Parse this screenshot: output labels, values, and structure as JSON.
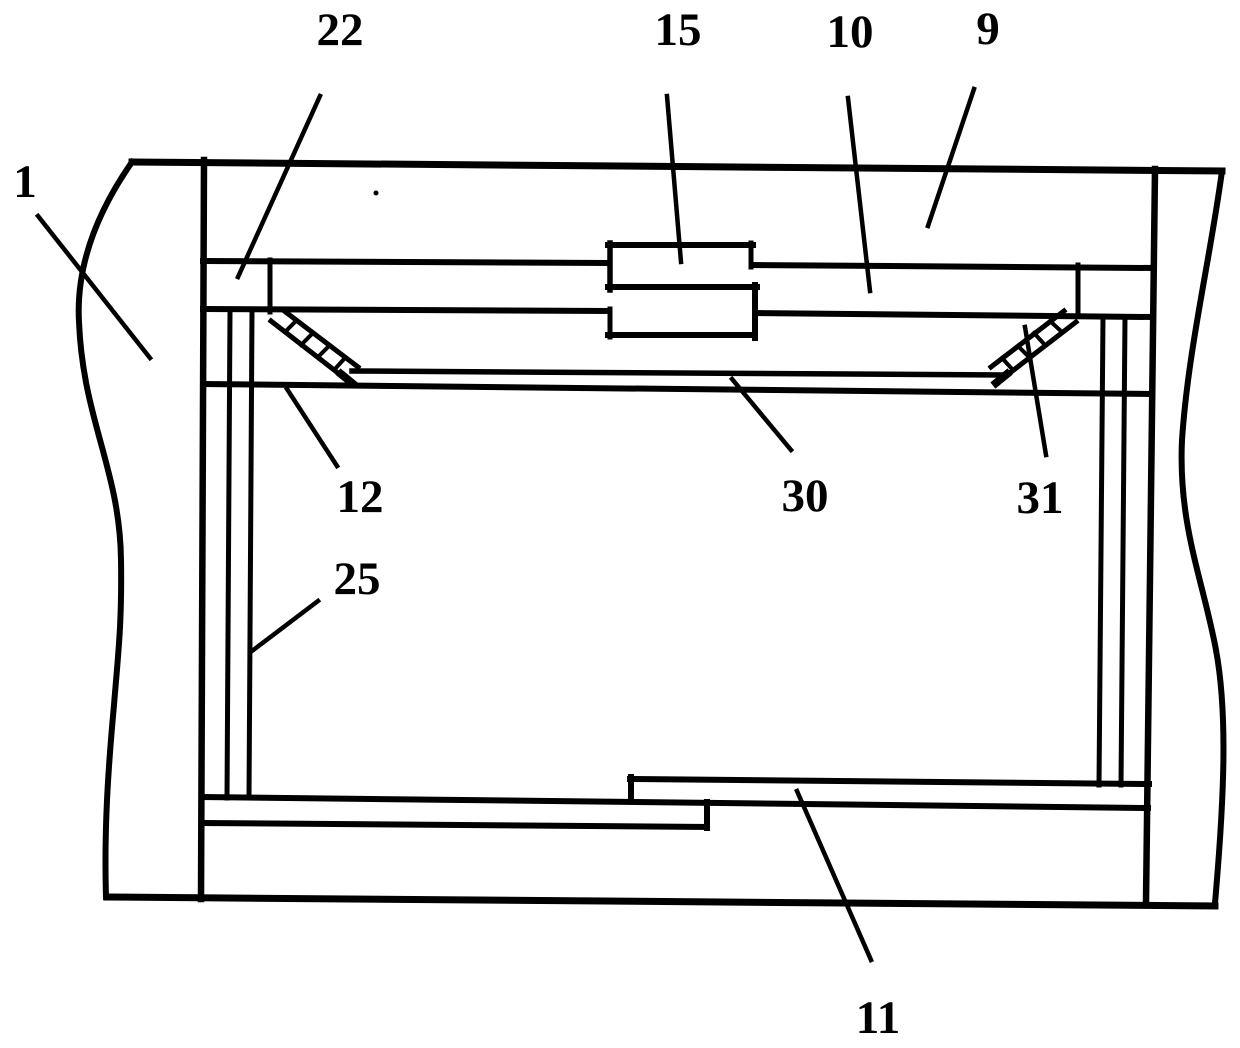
{
  "figure": {
    "background": "#ffffff",
    "ink": "#000000",
    "width": 1240,
    "height": 1048,
    "labels": [
      {
        "id": "1",
        "text": "1",
        "x": 25,
        "y": 180,
        "leader": {
          "x1": 38,
          "y1": 216,
          "x2": 150,
          "y2": 358
        }
      },
      {
        "id": "22",
        "text": "22",
        "x": 340,
        "y": 28,
        "leader": {
          "x1": 320,
          "y1": 96,
          "x2": 238,
          "y2": 277
        }
      },
      {
        "id": "15",
        "text": "15",
        "x": 678,
        "y": 28,
        "leader": {
          "x1": 667,
          "y1": 96,
          "x2": 681,
          "y2": 262
        }
      },
      {
        "id": "10",
        "text": "10",
        "x": 850,
        "y": 30,
        "leader": {
          "x1": 848,
          "y1": 98,
          "x2": 870,
          "y2": 291
        }
      },
      {
        "id": "9",
        "text": "9",
        "x": 988,
        "y": 27,
        "leader": {
          "x1": 974,
          "y1": 89,
          "x2": 928,
          "y2": 226
        }
      },
      {
        "id": "12",
        "text": "12",
        "x": 360,
        "y": 495,
        "leader": {
          "x1": 287,
          "y1": 389,
          "x2": 337,
          "y2": 466
        }
      },
      {
        "id": "25",
        "text": "25",
        "x": 357,
        "y": 577,
        "leader": {
          "x1": 318,
          "y1": 601,
          "x2": 252,
          "y2": 651
        }
      },
      {
        "id": "30",
        "text": "30",
        "x": 805,
        "y": 494,
        "leader": {
          "x1": 732,
          "y1": 379,
          "x2": 791,
          "y2": 450
        }
      },
      {
        "id": "31",
        "text": "31",
        "x": 1040,
        "y": 496,
        "leader": {
          "x1": 1025,
          "y1": 327,
          "x2": 1046,
          "y2": 455
        }
      },
      {
        "id": "11",
        "text": "11",
        "x": 878,
        "y": 1016,
        "leader": {
          "x1": 797,
          "y1": 791,
          "x2": 871,
          "y2": 960
        }
      }
    ],
    "lines": [
      {
        "name": "frame-top-edge",
        "x1": 132,
        "y1": 162,
        "x2": 1222,
        "y2": 171,
        "w": 7
      },
      {
        "name": "frame-bottom-edge",
        "x1": 107,
        "y1": 897,
        "x2": 1215,
        "y2": 906,
        "w": 7
      },
      {
        "name": "left-wall",
        "x1": 204,
        "y1": 160,
        "x2": 201,
        "y2": 899,
        "w": 6.5
      },
      {
        "name": "right-wall",
        "x1": 1155,
        "y1": 169,
        "x2": 1146,
        "y2": 902,
        "w": 6.5
      },
      {
        "name": "cover-top-rail-left",
        "x1": 203,
        "y1": 261,
        "x2": 608,
        "y2": 263,
        "w": 6
      },
      {
        "name": "cover-top-rail-right",
        "x1": 752,
        "y1": 265,
        "x2": 1152,
        "y2": 268,
        "w": 6
      },
      {
        "name": "cover-bottom-rail-left",
        "x1": 203,
        "y1": 309,
        "x2": 608,
        "y2": 311,
        "w": 6
      },
      {
        "name": "cover-bottom-rail-right",
        "x1": 755,
        "y1": 313,
        "x2": 1150,
        "y2": 317,
        "w": 6
      },
      {
        "name": "cover-endcap-left",
        "x1": 270,
        "y1": 260,
        "x2": 270,
        "y2": 312,
        "w": 5
      },
      {
        "name": "cover-endcap-right",
        "x1": 1078,
        "y1": 265,
        "x2": 1078,
        "y2": 316,
        "w": 5
      },
      {
        "name": "latch-top-edge",
        "x1": 608,
        "y1": 245,
        "x2": 753,
        "y2": 245,
        "w": 6
      },
      {
        "name": "latch-left-upper-edge",
        "x1": 610,
        "y1": 243,
        "x2": 610,
        "y2": 290,
        "w": 5.5
      },
      {
        "name": "latch-mid-edge",
        "x1": 608,
        "y1": 287,
        "x2": 757,
        "y2": 287,
        "w": 6
      },
      {
        "name": "latch-right-upper-edge",
        "x1": 751,
        "y1": 243,
        "x2": 751,
        "y2": 267,
        "w": 5
      },
      {
        "name": "latch-right-lower-edge",
        "x1": 755,
        "y1": 285,
        "x2": 755,
        "y2": 338,
        "w": 6
      },
      {
        "name": "latch-bottom-edge",
        "x1": 608,
        "y1": 335,
        "x2": 753,
        "y2": 335,
        "w": 6
      },
      {
        "name": "latch-left-lower-edge",
        "x1": 610,
        "y1": 309,
        "x2": 610,
        "y2": 337,
        "w": 5
      },
      {
        "name": "shelf-top-edge",
        "x1": 352,
        "y1": 371,
        "x2": 1002,
        "y2": 375,
        "w": 5.5
      },
      {
        "name": "shelf-support-line",
        "x1": 203,
        "y1": 384,
        "x2": 1150,
        "y2": 394,
        "w": 6
      },
      {
        "name": "left-post-outer",
        "x1": 230,
        "y1": 311,
        "x2": 227,
        "y2": 798,
        "w": 5
      },
      {
        "name": "left-post-inner",
        "x1": 252,
        "y1": 311,
        "x2": 249,
        "y2": 798,
        "w": 5
      },
      {
        "name": "right-post-inner",
        "x1": 1103,
        "y1": 317,
        "x2": 1099,
        "y2": 785,
        "w": 5
      },
      {
        "name": "right-post-outer",
        "x1": 1125,
        "y1": 317,
        "x2": 1121,
        "y2": 785,
        "w": 5
      },
      {
        "name": "floor-right-top-edge",
        "x1": 630,
        "y1": 779,
        "x2": 1149,
        "y2": 784,
        "w": 6
      },
      {
        "name": "floor-right-left-end",
        "x1": 631,
        "y1": 777,
        "x2": 631,
        "y2": 801,
        "w": 6
      },
      {
        "name": "floor-middle-edge",
        "x1": 203,
        "y1": 797,
        "x2": 1148,
        "y2": 808,
        "w": 6
      },
      {
        "name": "floor-left-bottom-edge",
        "x1": 203,
        "y1": 823,
        "x2": 707,
        "y2": 827,
        "w": 6
      },
      {
        "name": "floor-left-right-end",
        "x1": 707,
        "y1": 802,
        "x2": 707,
        "y2": 828,
        "w": 6
      },
      {
        "name": "left-brace-outer-edge",
        "x1": 283,
        "y1": 310,
        "x2": 358,
        "y2": 367,
        "w": 5
      },
      {
        "name": "left-brace-inner-edge",
        "x1": 271,
        "y1": 321,
        "x2": 347,
        "y2": 380,
        "w": 5
      },
      {
        "name": "left-brace-rung-1",
        "x1": 296,
        "y1": 321,
        "x2": 285,
        "y2": 332,
        "w": 4
      },
      {
        "name": "left-brace-rung-2",
        "x1": 313,
        "y1": 333,
        "x2": 301,
        "y2": 345,
        "w": 4
      },
      {
        "name": "left-brace-rung-3",
        "x1": 329,
        "y1": 346,
        "x2": 318,
        "y2": 357,
        "w": 4
      },
      {
        "name": "left-brace-rung-4",
        "x1": 345,
        "y1": 358,
        "x2": 334,
        "y2": 370,
        "w": 4
      },
      {
        "name": "left-brace-foot",
        "x1": 341,
        "y1": 374,
        "x2": 352,
        "y2": 383,
        "w": 8
      },
      {
        "name": "right-brace-outer-edge",
        "x1": 1064,
        "y1": 311,
        "x2": 991,
        "y2": 367,
        "w": 5
      },
      {
        "name": "right-brace-inner-edge",
        "x1": 1076,
        "y1": 322,
        "x2": 1002,
        "y2": 379,
        "w": 5
      },
      {
        "name": "right-brace-rung-1",
        "x1": 1050,
        "y1": 321,
        "x2": 1062,
        "y2": 332,
        "w": 4
      },
      {
        "name": "right-brace-rung-2",
        "x1": 1034,
        "y1": 333,
        "x2": 1045,
        "y2": 345,
        "w": 4
      },
      {
        "name": "right-brace-rung-3",
        "x1": 1018,
        "y1": 346,
        "x2": 1029,
        "y2": 357,
        "w": 4
      },
      {
        "name": "right-brace-rung-4",
        "x1": 1002,
        "y1": 358,
        "x2": 1013,
        "y2": 370,
        "w": 4
      },
      {
        "name": "right-brace-foot",
        "x1": 1007,
        "y1": 374,
        "x2": 996,
        "y2": 383,
        "w": 8
      }
    ],
    "curves": [
      {
        "name": "left-break-line",
        "d": "M132,162 C95,215 76,268 79,322 C83,420 120,470 121,560 C122,625 118,655 114,705 C108,770 104,830 106,897",
        "w": 6
      },
      {
        "name": "right-break-line",
        "d": "M1222,171 C1210,260 1188,350 1182,440 C1178,525 1203,580 1216,650 C1228,715 1224,800 1215,903",
        "w": 6
      }
    ],
    "dots": [
      {
        "name": "stray-dot",
        "x": 376,
        "y": 193,
        "r": 2.5
      }
    ]
  }
}
